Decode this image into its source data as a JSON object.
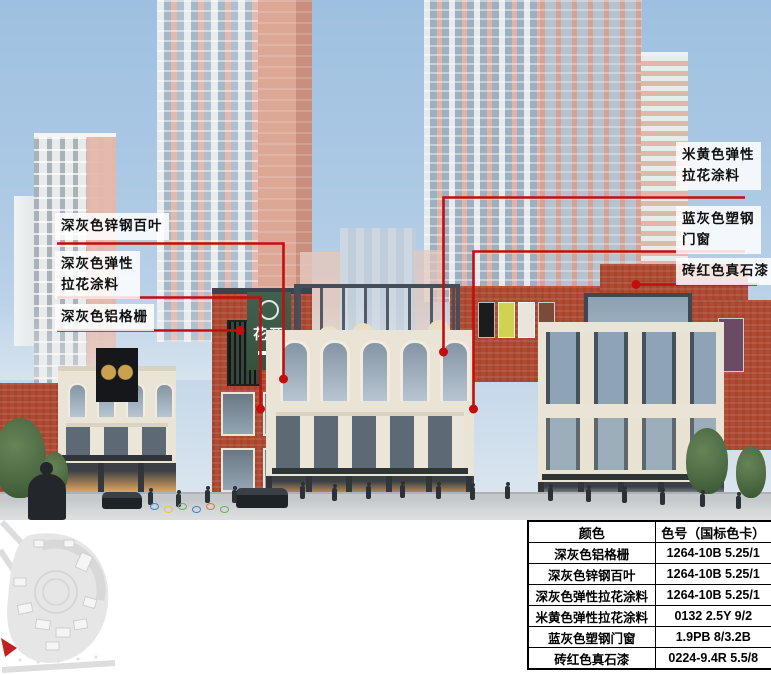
{
  "colors": {
    "accent_red": "#c50d0d",
    "brick_red": "#b04a33",
    "cream_beige": "#e9e4d5",
    "dark_gray": "#3c434a",
    "sign_green": "#3a5c4b",
    "blue_gray_glass": "#8ea4b6",
    "sky_blue": "#aecae5"
  },
  "annotations": {
    "left": [
      {
        "line1": "深灰色锌钢百叶"
      },
      {
        "line1": "深灰色弹性",
        "line2": "拉花涂料"
      },
      {
        "line1": "深灰色铝格栅"
      }
    ],
    "right": [
      {
        "line1": "米黄色弹性",
        "line2": "拉花涂料"
      },
      {
        "line1": "蓝灰色塑钢",
        "line2": "门窗"
      },
      {
        "line1": "砖红色真石漆"
      }
    ]
  },
  "signboard": {
    "name": "花开"
  },
  "table": {
    "headers": [
      "颜色",
      "色号（国标色卡）"
    ],
    "rows": [
      [
        "深灰色铝格栅",
        "1264-10B 5.25/1"
      ],
      [
        "深灰色锌钢百叶",
        "1264-10B 5.25/1"
      ],
      [
        "深灰色弹性拉花涂料",
        "1264-10B 5.25/1"
      ],
      [
        "米黄色弹性拉花涂料",
        "0132 2.5Y 9/2"
      ],
      [
        "蓝灰色塑钢门窗",
        "1.9PB 8/3.2B"
      ],
      [
        "砖红色真石漆",
        "0224-9.4R 5.5/8"
      ]
    ]
  }
}
